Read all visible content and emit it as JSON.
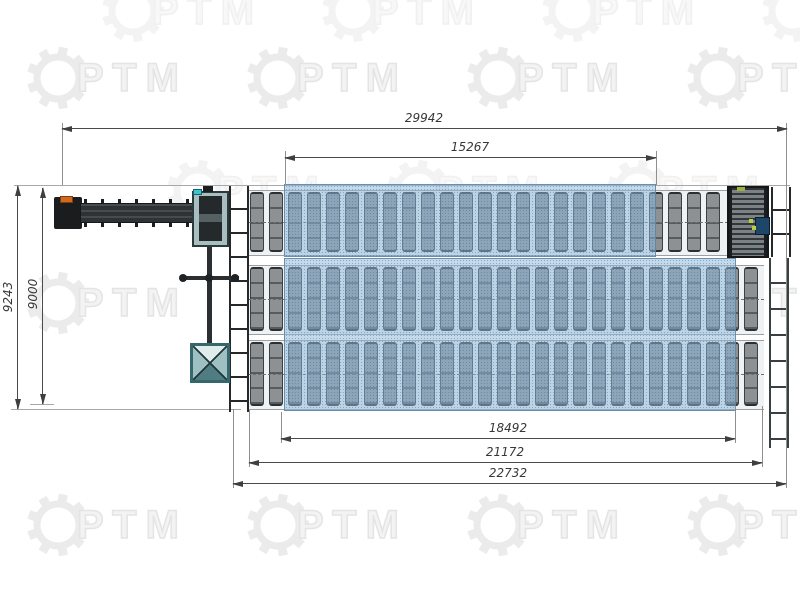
{
  "watermark": {
    "brand_text": "РТМ"
  },
  "dimensions": {
    "top_overall_mm": "29942",
    "top_active_zone_mm": "15267",
    "left_overall_mm": "9243",
    "left_inner_mm": "9000",
    "bottom_active_zone_mm": "18492",
    "bottom_conveyor_mm": "21172",
    "bottom_overall_mm": "22732"
  },
  "colors": {
    "highlight_zone_fill": "#8db8d9",
    "roller_gray": "#8d9194",
    "machine_dark": "#31363a",
    "machine_teal": "#a8bec0",
    "accent_orange": "#d2691f",
    "accent_cyan": "#39c6d4",
    "accent_yellow_green": "#b9cf3e",
    "dimension_line": "#4a4a4a",
    "watermark_gray": "#ebebeb"
  },
  "conveyor": {
    "rows": [
      {
        "id": "line-1",
        "rollers": 25
      },
      {
        "id": "line-2",
        "rollers": 27
      },
      {
        "id": "line-3",
        "rollers": 27
      }
    ]
  }
}
